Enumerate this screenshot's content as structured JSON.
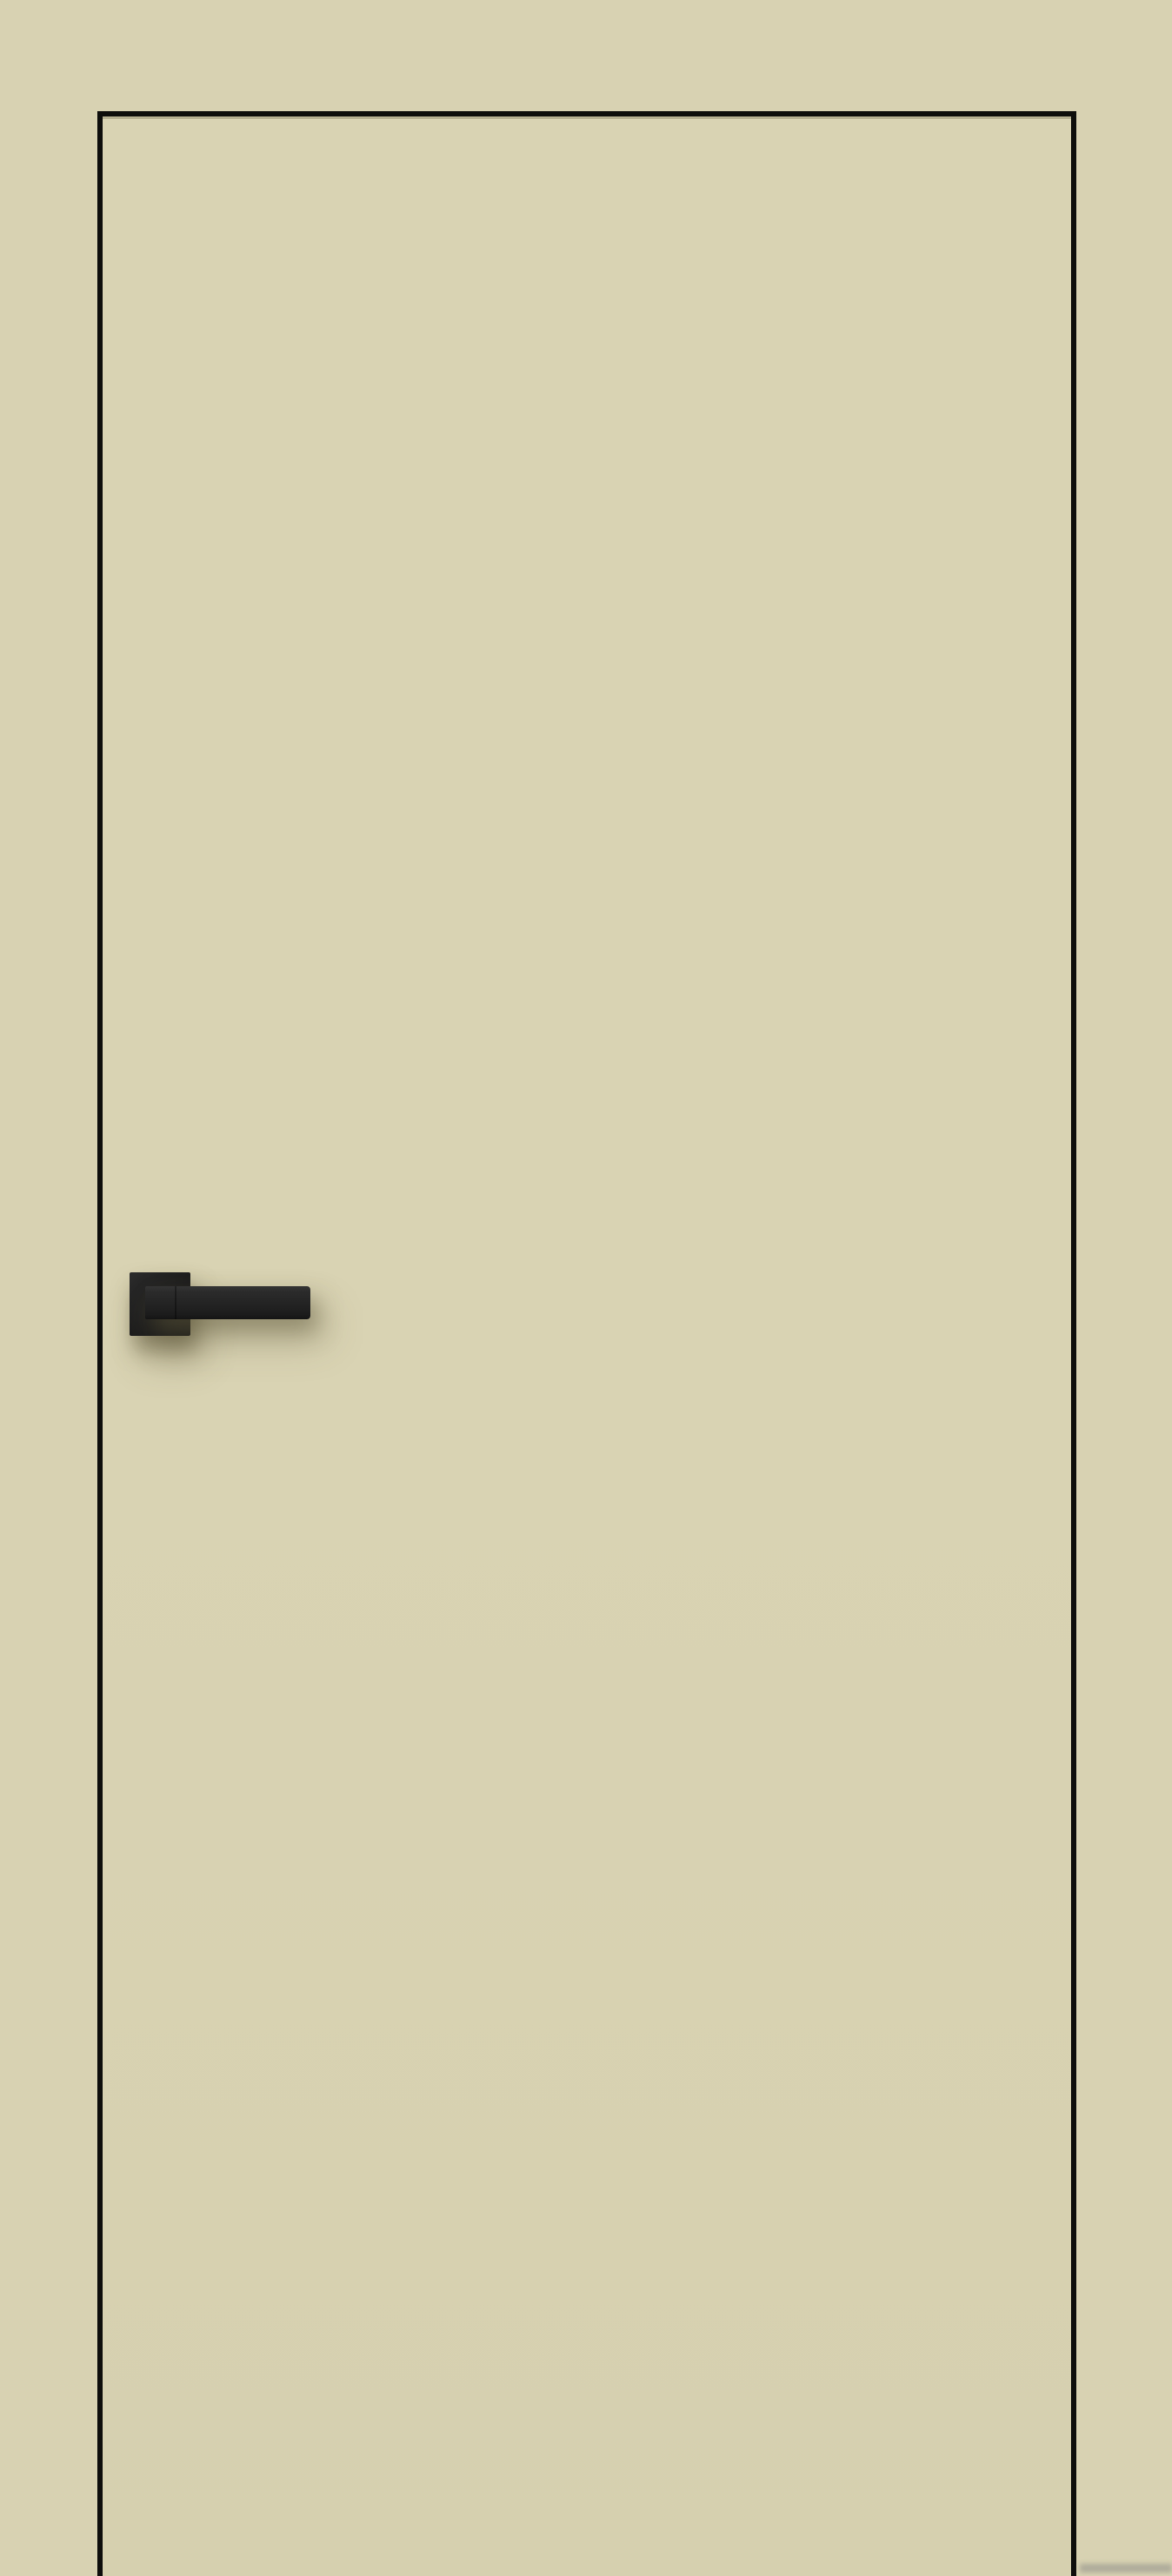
{
  "colors": {
    "background": "#d8d2b2",
    "door-face": "#d9d3b3",
    "door-trim": "#0e0e0c",
    "handle-dark": "#1c1c1c",
    "handle-mid": "#2b2b2b",
    "shadow": "rgba(96,90,60,0.5)"
  },
  "icons": {
    "door-handle": "black square-rose lever handle, css-shape"
  },
  "objects": {
    "door": {
      "label": "door-panel"
    },
    "handle": {
      "label": "door-handle"
    }
  }
}
